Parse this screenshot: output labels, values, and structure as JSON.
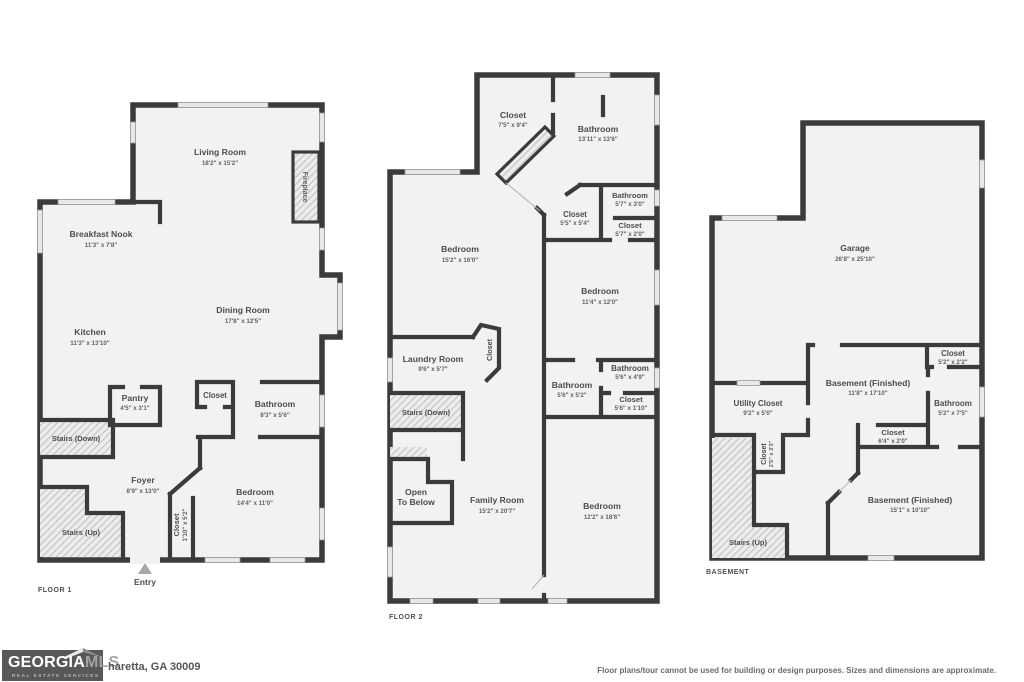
{
  "floor1": {
    "title": "FLOOR 1",
    "entry": "Entry",
    "rooms": {
      "living": {
        "name": "Living Room",
        "dims": "18'2\" x 15'2\""
      },
      "breakfast": {
        "name": "Breakfast Nook",
        "dims": "11'3\" x 7'8\""
      },
      "kitchen": {
        "name": "Kitchen",
        "dims": "11'3\" x 13'10\""
      },
      "dining": {
        "name": "Dining Room",
        "dims": "17'8\" x 12'5\""
      },
      "fireplace": {
        "name": "Fireplace"
      },
      "pantry": {
        "name": "Pantry",
        "dims": "4'5\" x 3'1\""
      },
      "stairs_down": {
        "name": "Stairs (Down)"
      },
      "stairs_up": {
        "name": "Stairs (Up)"
      },
      "foyer": {
        "name": "Foyer",
        "dims": "8'9\" x 13'0\""
      },
      "hall_closet": {
        "name": "Closet"
      },
      "bathroom": {
        "name": "Bathroom",
        "dims": "8'3\" x 5'6\""
      },
      "bedroom": {
        "name": "Bedroom",
        "dims": "14'4\" x 11'0\""
      },
      "entry_closet": {
        "name": "Closet",
        "dims": "1'10\" x 5'2\""
      }
    }
  },
  "floor2": {
    "title": "FLOOR 2",
    "rooms": {
      "upper_closet": {
        "name": "Closet",
        "dims": "7'5\" x 9'4\""
      },
      "upper_bathroom": {
        "name": "Bathroom",
        "dims": "13'11\" x 13'6\""
      },
      "small_bathroom": {
        "name": "Bathroom",
        "dims": "5'7\" x 3'0\""
      },
      "small_closet": {
        "name": "Closet",
        "dims": "5'7\" x 2'0\""
      },
      "mid_closet": {
        "name": "Closet",
        "dims": "5'5\" x 5'4\""
      },
      "bedroom_front": {
        "name": "Bedroom",
        "dims": "15'2\" x 16'0\""
      },
      "bedroom_right": {
        "name": "Bedroom",
        "dims": "11'4\" x 12'0\""
      },
      "laundry": {
        "name": "Laundry Room",
        "dims": "9'6\" x 5'7\""
      },
      "laundry_closet": {
        "name": "Closet"
      },
      "stairs_down": {
        "name": "Stairs (Down)"
      },
      "hall_bathroom": {
        "name": "Bathroom",
        "dims": "5'6\" x 5'2\""
      },
      "right_bathroom": {
        "name": "Bathroom",
        "dims": "5'6\" x 4'9\""
      },
      "right_closet": {
        "name": "Closet",
        "dims": "5'6\" x 1'10\""
      },
      "open_below": {
        "line1": "Open",
        "line2": "To Below"
      },
      "family": {
        "name": "Family Room",
        "dims": "15'2\" x 20'7\""
      },
      "bedroom_rear": {
        "name": "Bedroom",
        "dims": "12'2\" x 18'6\""
      }
    }
  },
  "basement": {
    "title": "BASEMENT",
    "rooms": {
      "garage": {
        "name": "Garage",
        "dims": "26'8\" x 25'10\""
      },
      "top_closet": {
        "name": "Closet",
        "dims": "5'2\" x 2'2\""
      },
      "finished_a": {
        "name": "Basement (Finished)",
        "dims": "11'8\" x 17'10\""
      },
      "bathroom": {
        "name": "Bathroom",
        "dims": "5'2\" x 7'5\""
      },
      "mid_closet": {
        "name": "Closet",
        "dims": "6'4\" x 2'0\""
      },
      "utility": {
        "name": "Utility Closet",
        "dims": "9'2\" x 5'0\""
      },
      "stairs_closet": {
        "name": "Closet",
        "dims": "2'5\" x 3'3\""
      },
      "finished_b": {
        "name": "Basement (Finished)",
        "dims": "15'1\" x 10'10\""
      },
      "stairs_up": {
        "name": "Stairs (Up)"
      }
    }
  },
  "footer": {
    "logo": {
      "georgia": "GEORGIA",
      "mls": "MLS",
      "tagline": "REAL ESTATE SERVICES"
    },
    "address": "haretta, GA 30009",
    "disclaimer": "Floor plans/tour cannot be used for building or design purposes. Sizes and dimensions are approximate."
  }
}
